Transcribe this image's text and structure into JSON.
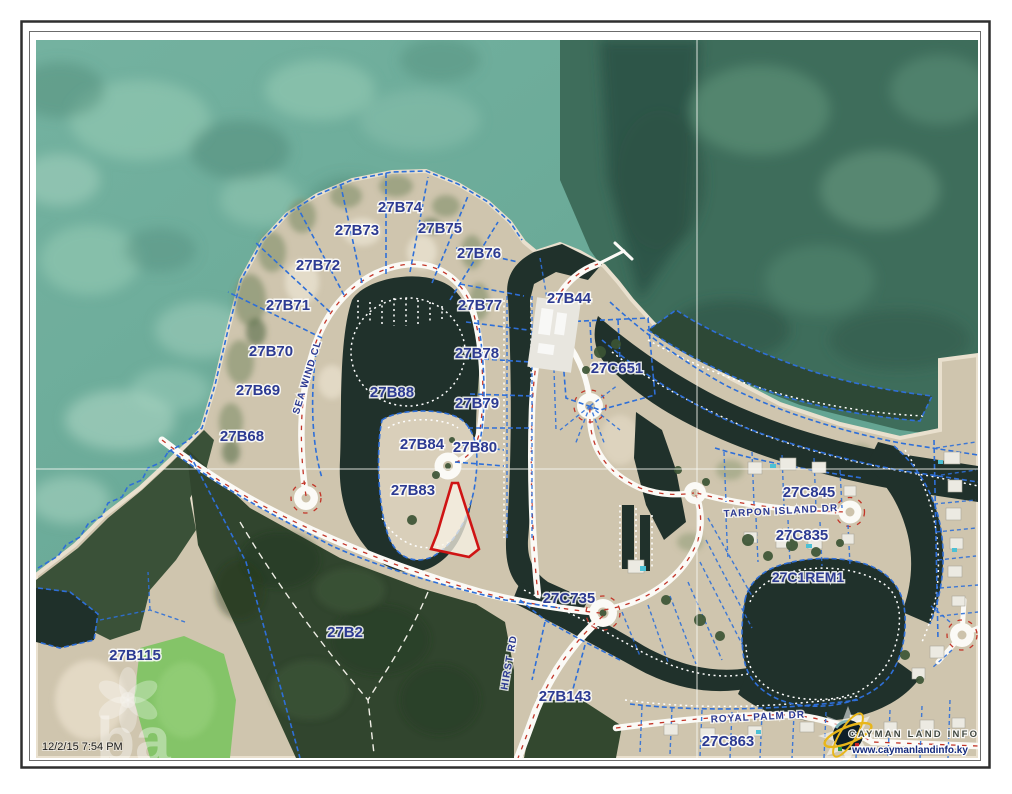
{
  "map": {
    "type": "cadastral-aerial-parcel-map",
    "timestamp": "12/2/15 7:54 PM",
    "watermark_text": "ba",
    "parcel_labels": [
      "27B74",
      "27B73",
      "27B75",
      "27B72",
      "27B76",
      "27B71",
      "27B77",
      "27B44",
      "27B70",
      "27B78",
      "27C651",
      "27B69",
      "27B88",
      "27B79",
      "27B68",
      "27B84",
      "27B80",
      "27B83",
      "27C845",
      "27C835",
      "27C1REM1",
      "27C735",
      "27B2",
      "27B115",
      "27B143",
      "27C863"
    ],
    "road_labels": [
      "SEA WIND CL",
      "TARPON ISLAND DR",
      "HIRST RD",
      "ROYAL PALM DR"
    ],
    "highlighted_parcel": {
      "outline_color": "#cf1414",
      "near_label": "27B83"
    },
    "legend_colors": {
      "parcel_line": "#2e6fd8",
      "label_text": "#2c3a92",
      "road_centerline": "#c23528",
      "highlight": "#cf1414"
    },
    "branding": {
      "name": "CAYMAN LAND INFO",
      "website": "www.caymanlandinfo.ky"
    }
  }
}
